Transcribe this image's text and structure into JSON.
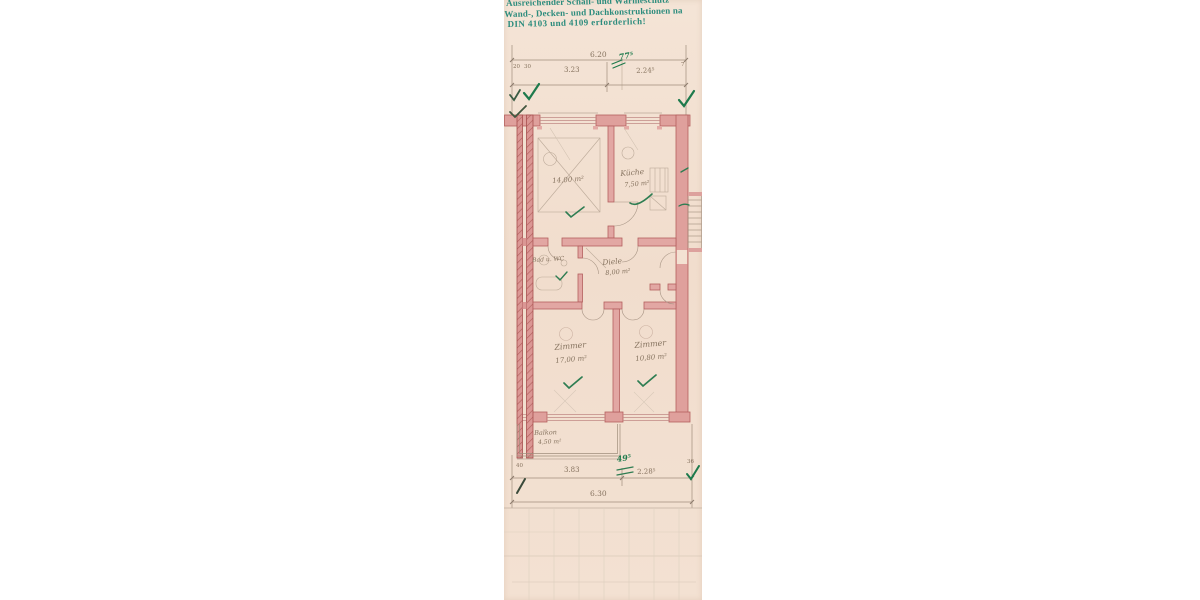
{
  "stamp": {
    "line1": "Ausreichender Schall- und Wärmeschutz",
    "line2": "Wand-, Decken- und Dachkonstruktionen na",
    "line3": "DIN 4103 und 4109 erforderlich!",
    "ink_color": "#2c8c7d"
  },
  "dimensions": {
    "top": {
      "overall": "6.20",
      "segment1": "3.23",
      "segment2": "2.24⁵",
      "small_left1": "20",
      "small_left2": "30",
      "small_right": "7",
      "green_note": "77⁵"
    },
    "bottom": {
      "overall": "6.30",
      "segment1": "3.83",
      "segment2": "2.28⁵",
      "small_left": "40",
      "small_right": "36",
      "green_note": "49⁵"
    }
  },
  "rooms": {
    "room1": {
      "area": "14,00 m²"
    },
    "kueche": {
      "name": "Küche",
      "area": "7,50 m²"
    },
    "bad": {
      "name": "Bad u. WC"
    },
    "diele": {
      "name": "Diele",
      "area": "8,00 m²"
    },
    "zimmer1": {
      "name": "Zimmer",
      "area": "17,00 m²"
    },
    "zimmer2": {
      "name": "Zimmer",
      "area": "10,80 m²"
    },
    "balkon": {
      "name": "Balkon",
      "area": "4,50 m²"
    }
  },
  "colors": {
    "paper": "#f3e1d2",
    "wall_red": "#dfa09c",
    "wall_red_stroke": "#b4605e",
    "pencil": "#a08e7c",
    "pencil_text": "#86735f",
    "green_ink": "#1d7a4c",
    "stamp_teal": "#2c8c7d",
    "background": "#ffffff"
  }
}
